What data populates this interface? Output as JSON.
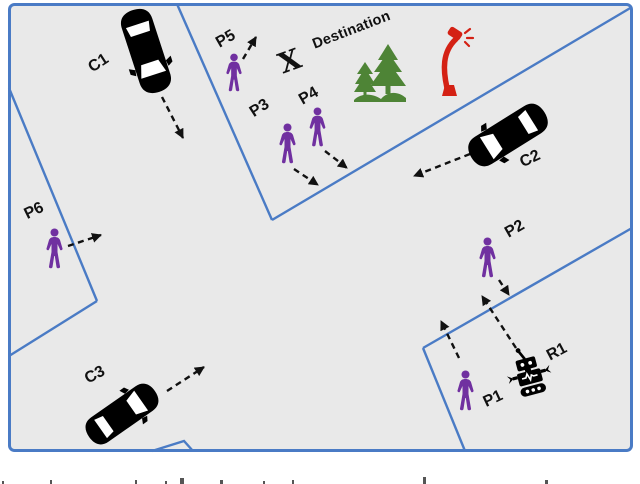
{
  "figure": {
    "destination": {
      "marker": "X",
      "label": "Destination"
    },
    "cars": [
      {
        "id": "C1"
      },
      {
        "id": "C2"
      },
      {
        "id": "C3"
      }
    ],
    "pedestrians": [
      {
        "id": "P1"
      },
      {
        "id": "P2"
      },
      {
        "id": "P3"
      },
      {
        "id": "P4"
      },
      {
        "id": "P5"
      },
      {
        "id": "P6"
      }
    ],
    "robot": {
      "id": "R1"
    },
    "colors": {
      "background": "#e9e9e9",
      "road_line": "#4a7bc5",
      "car": "#000000",
      "pedestrian": "#7030a0",
      "tree": "#4e8436",
      "lamp": "#d42114",
      "arrow": "#111111",
      "label": "#111111"
    }
  }
}
